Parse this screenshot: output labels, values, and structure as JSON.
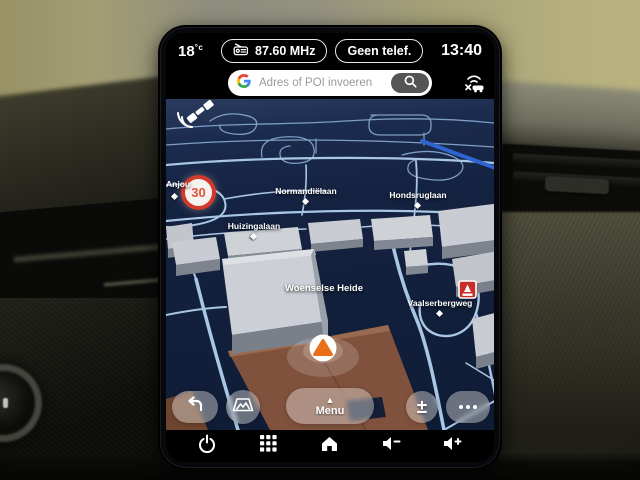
{
  "status_bar": {
    "temperature": "18",
    "temperature_unit": "°c",
    "radio_station": "87.60 MHz",
    "phone_status": "Geen telef.",
    "clock": "13:40"
  },
  "search": {
    "placeholder": "Adres of POI invoeren"
  },
  "map": {
    "speed_limit_sign": {
      "value": "30"
    },
    "street_labels": [
      {
        "text": "Anjou",
        "type": "street"
      },
      {
        "text": "Normandiëlaan",
        "type": "street"
      },
      {
        "text": "Hondsruglaan",
        "type": "street"
      },
      {
        "text": "Huizingalaan",
        "type": "street"
      },
      {
        "text": "Woenselse Heide",
        "type": "area"
      },
      {
        "text": "Vaalserbergweg",
        "type": "street"
      }
    ],
    "poi": [
      {
        "name": "fuel-station",
        "color": "#c62f26"
      }
    ],
    "vehicle_marker": {
      "color": "#e8701a"
    }
  },
  "map_controls": {
    "menu_label": "Menu"
  },
  "icons": {
    "menu_arrow": "▲",
    "zoom": "±"
  },
  "colors": {
    "map_background": "#13203c",
    "road": "#a9c7e4",
    "highlighted_road": "#2f63cf",
    "building_top": "#c9cdd3",
    "ground_brown": "#80523d",
    "marker_orange": "#e8701a",
    "sign_red": "#d3392b"
  }
}
